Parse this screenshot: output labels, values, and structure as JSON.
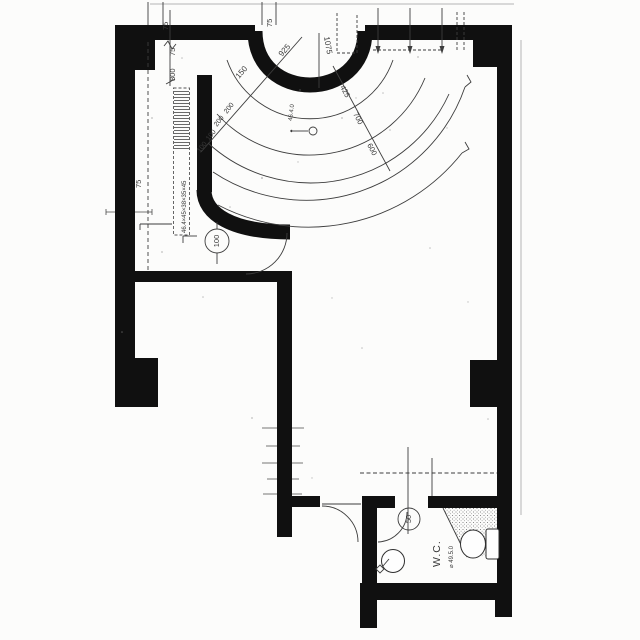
{
  "drawing": {
    "room_labels": {
      "wc": "W.C."
    },
    "dimensions": {
      "top_left_75": "75",
      "top_mid_75": "75",
      "chain_75": "75",
      "chain_800": "800",
      "left_75": "75",
      "arc_925": "925",
      "arc_150": "150",
      "arc_1075": "1075",
      "arc_200_a": "200",
      "arc_200_b": "200",
      "arc_100_a": "100",
      "arc_100_b": "100",
      "arc_425": "425",
      "arc_700": "700",
      "arc_600": "600",
      "circled_100": "100",
      "circled_50": "50"
    },
    "annotations": {
      "shelf_note": "46.4×45×38×35×45",
      "level_note": "46.4.0",
      "wc_note": "⌀ 49.5.0"
    },
    "icons": {
      "toilet": "plan-toilet-symbol",
      "wash_basin": "circle-basin-symbol",
      "door_swing": "quarter-arc-symbol"
    },
    "colors": {
      "wall": "#101010",
      "line": "#3d3d3d",
      "background": "#fcfcfb"
    }
  }
}
